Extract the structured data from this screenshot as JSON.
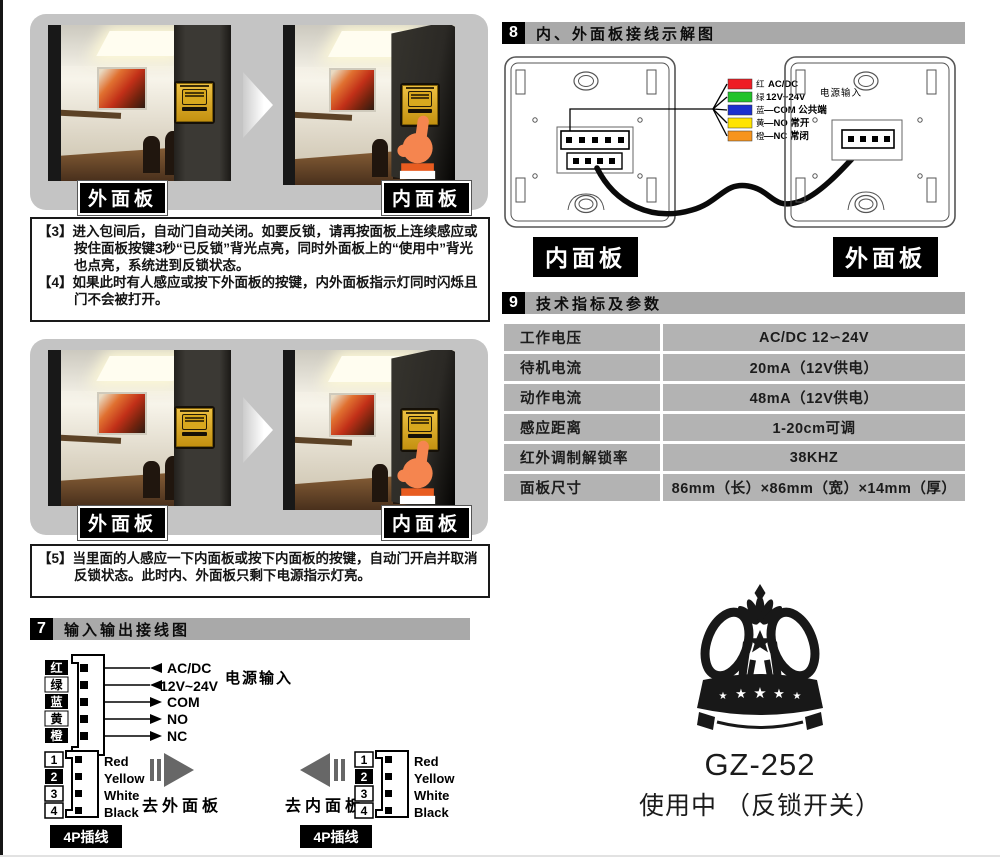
{
  "flow1": {
    "left_label": "外面板",
    "right_label": "内面板"
  },
  "flow2": {
    "left_label": "外面板",
    "right_label": "内面板"
  },
  "notes34": {
    "tag3": "【3】",
    "text3": "进入包间后，自动门自动关闭。如要反锁，请再按面板上连续感应或按住面板按键3秒“已反锁”背光点亮，同时外面板上的“使用中”背光也点亮，系统进到反锁状态。",
    "tag4": "【4】",
    "text4": "如果此时有人感应或按下外面板的按键，内外面板指示灯同时闪烁且门不会被打开。"
  },
  "note5": {
    "tag": "【5】",
    "text": "当里面的人感应一下内面板或按下内面板的按键，自动门开启并取消反锁状态。此时内、外面板只剩下电源指示灯亮。"
  },
  "section7": {
    "num": "7",
    "title": "输入输出接线图",
    "wire_labels": [
      "红",
      "绿",
      "蓝",
      "黄",
      "橙"
    ],
    "sig_acdc": "AC/DC",
    "sig_v": "12V~24V",
    "power_in": "电源输入",
    "sig_com": "COM",
    "sig_no": "NO",
    "sig_nc": "NC",
    "plug_nums": [
      "1",
      "2",
      "3",
      "4"
    ],
    "plug_colors": [
      "Red",
      "Yellow",
      "White",
      "Black"
    ],
    "to_outer": "去外面板",
    "to_inner": "去内面板",
    "plug_badge": "4P插线"
  },
  "section8": {
    "num": "8",
    "title": "内、外面板接线示解图",
    "legend": [
      {
        "cn": "红",
        "desc": "AC/DC",
        "color": "#ee1c25"
      },
      {
        "cn": "绿",
        "desc": "12V~24V",
        "color": "#22c32a"
      },
      {
        "cn": "蓝",
        "desc": "—COM 公共端",
        "color": "#1b2fce"
      },
      {
        "cn": "黄",
        "desc": "—NO 常开",
        "color": "#ffe400"
      },
      {
        "cn": "橙",
        "desc": "—NC 常闭",
        "color": "#f7941d"
      }
    ],
    "power_in": "电源输入",
    "inner_label": "内面板",
    "outer_label": "外面板"
  },
  "section9": {
    "num": "9",
    "title": "技术指标及参数",
    "rows": [
      {
        "name": "工作电压",
        "value": "AC/DC 12∽24V"
      },
      {
        "name": "待机电流",
        "value": "20mA（12V供电）"
      },
      {
        "name": "动作电流",
        "value": "48mA（12V供电）"
      },
      {
        "name": "感应距离",
        "value": "1-20cm可调"
      },
      {
        "name": "红外调制解锁率",
        "value": "38KHZ"
      },
      {
        "name": "面板尺寸",
        "value": "86mm（长）×86mm（宽）×14mm（厚）"
      }
    ]
  },
  "brand": {
    "model": "GZ-252",
    "subtitle": "使用中 （反锁开关）"
  }
}
